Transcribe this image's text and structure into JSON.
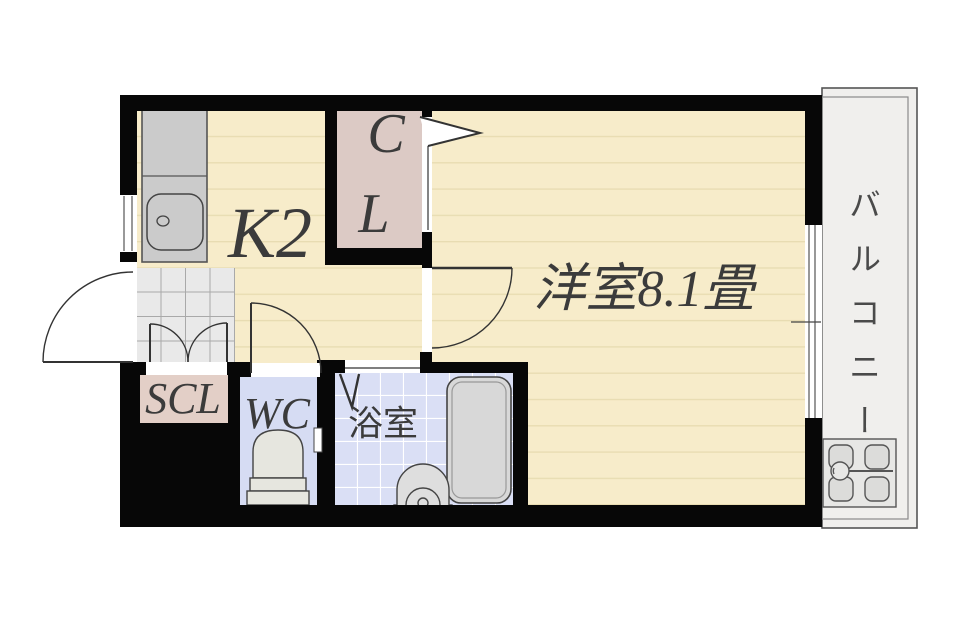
{
  "floorplan": {
    "type": "apartment-floor-plan",
    "colors": {
      "wall": "#070707",
      "room_floor": "#f7ecca",
      "closet": "#dccac5",
      "scl": "#e3cfc7",
      "entry_tile": "#e9e9e9",
      "wet_room": "#d6dcf3",
      "bath_tile": "#dadff5",
      "balcony": "#f0efed",
      "fixture": "#cbcbcb",
      "tub": "#d8d8d8",
      "fixture_light": "#e6e6df",
      "outline": "#444444",
      "label_text": "#3b3b3b"
    },
    "rooms": {
      "kitchen": {
        "label": "K2"
      },
      "closet": {
        "label": "CL",
        "label_lines": [
          "C",
          "L"
        ]
      },
      "main_room": {
        "label": "洋室8.1畳"
      },
      "shoe_closet": {
        "label": "SCL"
      },
      "toilet": {
        "label": "WC"
      },
      "bathroom": {
        "label": "浴室"
      },
      "balcony": {
        "label": "バルコニー"
      }
    }
  }
}
